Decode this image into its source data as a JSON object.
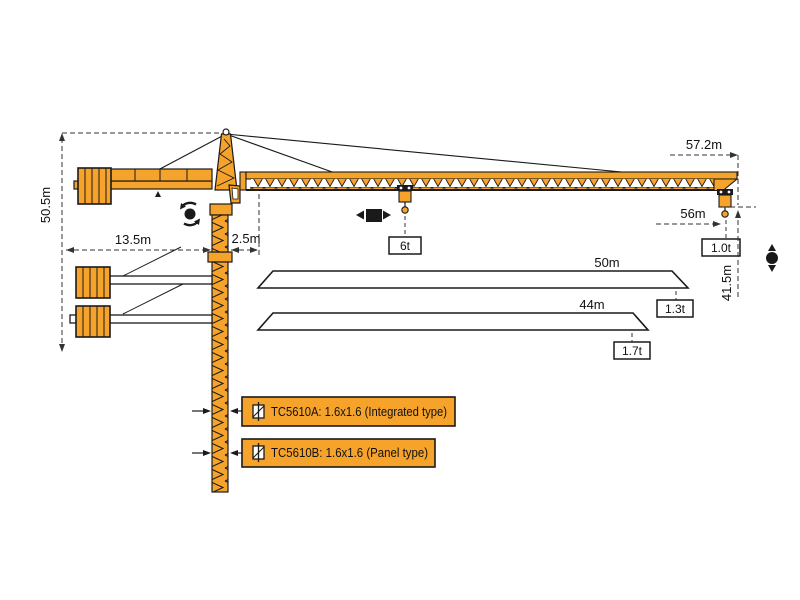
{
  "diagram": {
    "type": "tower-crane-specification-drawing",
    "colors": {
      "crane_orange": "#F5A32A",
      "outline": "#1A1A1A",
      "dimension_line": "#333333",
      "background": "#FFFFFF"
    },
    "dims": {
      "height_under_hook": "50.5m",
      "counter_jib_radius": "13.5m",
      "rear_offset": "2.5m",
      "max_working_radius": "57.2m",
      "tip_radius": "56m",
      "hoisting_height": "41.5m"
    },
    "loads": {
      "max_capacity": "6t",
      "tip_load_max_jib": "1.0t"
    },
    "jib_options": [
      {
        "length": "50m",
        "tip_load": "1.3t"
      },
      {
        "length": "44m",
        "tip_load": "1.7t"
      }
    ],
    "mast_labels": [
      {
        "text": "TC5610A: 1.6x1.6 (Integrated type)"
      },
      {
        "text": "TC5610B: 1.6x1.6 (Panel type)"
      }
    ]
  }
}
